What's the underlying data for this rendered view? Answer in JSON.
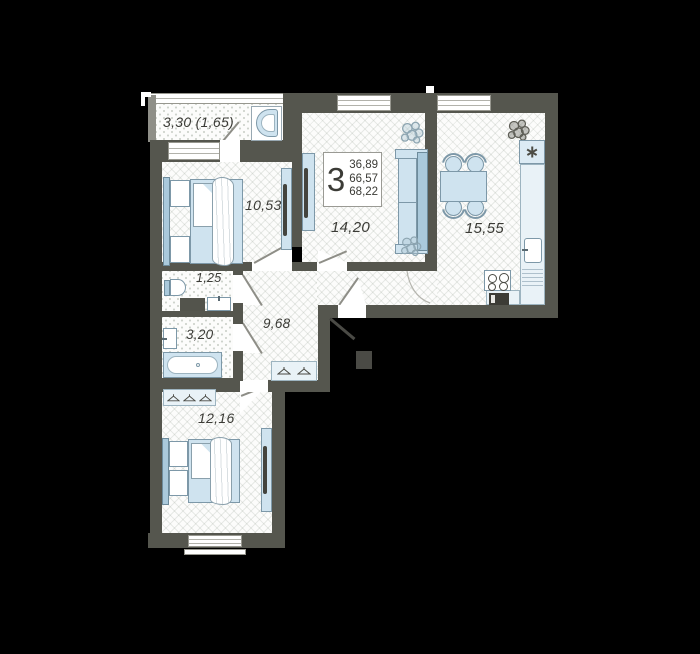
{
  "title": "3-room apartment floor plan",
  "summary": {
    "rooms_count": "3",
    "area_1": "36,89",
    "area_2": "66,57",
    "area_3": "68,22"
  },
  "rooms": {
    "balcony": "3,30 (1,65)",
    "bedroom1": "10,53",
    "living": "14,20",
    "kitchen": "15,55",
    "wc": "1,25",
    "bathroom": "3,20",
    "hallway": "9,68",
    "bedroom2": "12,16"
  },
  "icons": {
    "fridge": "snowflake-icon",
    "wardrobe": "hanger-icon",
    "decor": "plant-icon"
  },
  "colors": {
    "background": "#000000",
    "wall": "#55564e",
    "furniture_fill": "#cfe3ef",
    "furniture_border": "#7d98a8",
    "floor_pattern": "#dfe4de",
    "text": "#3b3b36"
  }
}
